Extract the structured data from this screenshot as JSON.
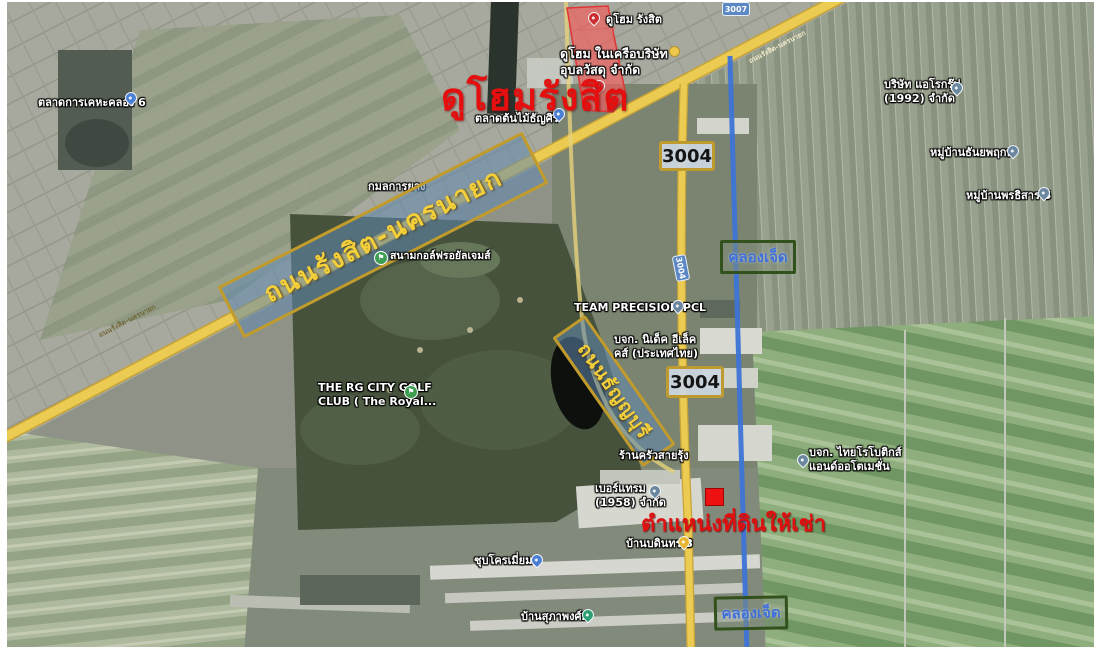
{
  "colors": {
    "annotation_red": "#e60f0f",
    "road_highlight_yellow": "#eccb52",
    "canal_blue": "#3d74d6",
    "road_label_text_yellow": "#f3cf3a",
    "road_label_border_gold": "#c19b2b",
    "canal_label_border_green": "#33511c",
    "canal_label_text_blue": "#3f6fd8",
    "site_highlight_fill": "#f45c5c",
    "land_marker_red": "#ee1111"
  },
  "annotations": {
    "dohome_title": "ดูโฮมรังสิต",
    "land_position": "ตำแหน่งที่ดินให้เช่า"
  },
  "roads": {
    "rangsit_nakhonnayok": "ถนนรังสิต-นครนายก",
    "thanyaburi": "ถนนธัญญบุรี",
    "small_road_name_left": "ถนนรังสิต-นครนายก",
    "small_road_name_right": "ถนนรังสิต-นครนายก"
  },
  "route_shields": {
    "shield_3004_upper": "3004",
    "shield_3004_lower": "3004",
    "marker_3004_on_road": "3004",
    "marker_3007": "3007"
  },
  "canal": {
    "label_upper": "คลองเจ็ด",
    "label_lower": "คลองเจ็ด"
  },
  "places": {
    "dohome_pin": "ดูโฮม รังสิต",
    "dohome_company": {
      "line1": "ดูโฮม ในเครือบริษัท",
      "line2": "อุบลวัสดุ จำกัด"
    },
    "kheha_market": "ตลาดการเคหะคลอง 6",
    "tree_market": "ตลาดต้นไม้ธัญศิริ",
    "kamol_tire": "กมลการยาง",
    "royal_gems_golf": "สนามกอล์ฟรอยัลเจมส์",
    "team_precision": "TEAM PRECISION PCL",
    "nidec": {
      "line1": "บจก. นิเด็ค อีเล็ค",
      "line2": "คส์ (ประเทศไทย)"
    },
    "rg_city_golf": {
      "line1": "THE RG CITY GOLF",
      "line2": "CLUB ( The Royal..."
    },
    "krua_sairung": "ร้านครัวสายรุ้ง",
    "bertram": {
      "line1": "เบอร์แทรม",
      "line2": "(1958) จำกัด"
    },
    "ban_bodin": "บ้านบดินทร 3",
    "chrome_plating": "ชุบโครเมี่ยม",
    "ban_supapong": "บ้านสุภาพงศ์2",
    "aero_group": {
      "line1": "บริษัท แอโรกรุ๊ป",
      "line2": "(1992) จำกัด"
    },
    "thanyaphruek_village": "หมู่บ้านธันยพฤกษ์",
    "pornthisan_village": "หมู่บ้านพรธิสาร 5",
    "thai_robotics": {
      "line1": "บจก. ไทยโรโบติกส์",
      "line2": "แอนด์ออโตเมชั่น"
    }
  }
}
